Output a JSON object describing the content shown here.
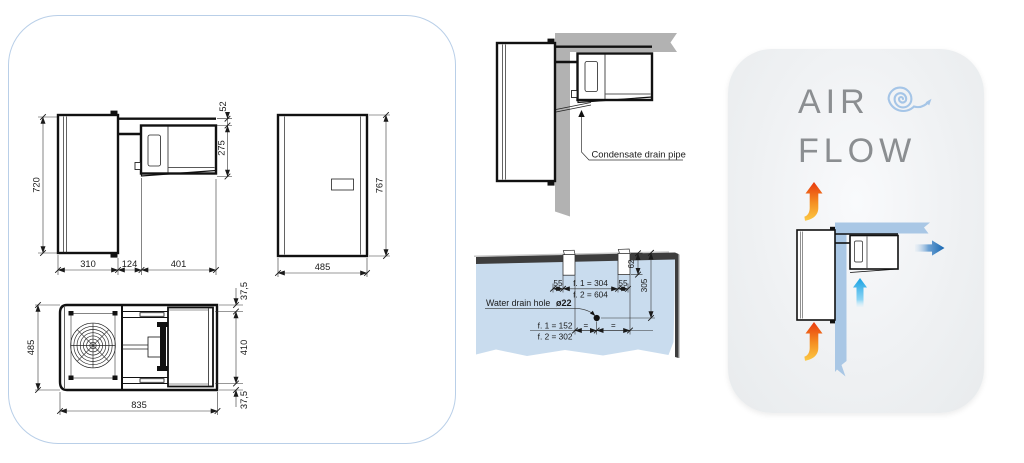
{
  "left_panel": {
    "side_view": {
      "height": "720",
      "gap_top": "52",
      "evap_height": "275",
      "depth_condenser": "310",
      "wall_gap": "124",
      "evap_depth": "401"
    },
    "front_view": {
      "width": "485",
      "height": "767"
    },
    "top_view": {
      "depth": "485",
      "margin_top": "37,5",
      "inner_width": "410",
      "margin_bottom": "37,5",
      "length": "835"
    }
  },
  "installation": {
    "wall_section": {
      "callout": "Condensate drain pipe"
    },
    "drill_template": {
      "offset_left": "55",
      "pitch_f1": "f. 1 = 304",
      "pitch_f2": "f. 2 = 604",
      "offset_right": "55",
      "notch_depth": "62",
      "vertical_offset": "305",
      "drain_label": "Water drain hole",
      "drain_diameter": "ø22",
      "center_f1": "f. 1 = 152",
      "center_f2": "f. 2 = 302",
      "equal_left": "=",
      "equal_right": "="
    }
  },
  "airflow_panel": {
    "title_line1": "AIR",
    "title_line2": "FLOW"
  },
  "colors": {
    "panel_border": "#b9cfe8",
    "wall_gray": "#b2b2b2",
    "template_blue": "#c9dcee",
    "template_dark": "#3d3d3d",
    "flow_wall_blue": "#a9c7e5",
    "hot_start": "#e8380d",
    "hot_end": "#fcc945",
    "cold_blue": "#18a2e2",
    "out_blue": "#1566b1",
    "spiral_blue": "#a5c5e7",
    "title_gray": "#8b8e91",
    "line_dark": "#1a1a1a"
  }
}
